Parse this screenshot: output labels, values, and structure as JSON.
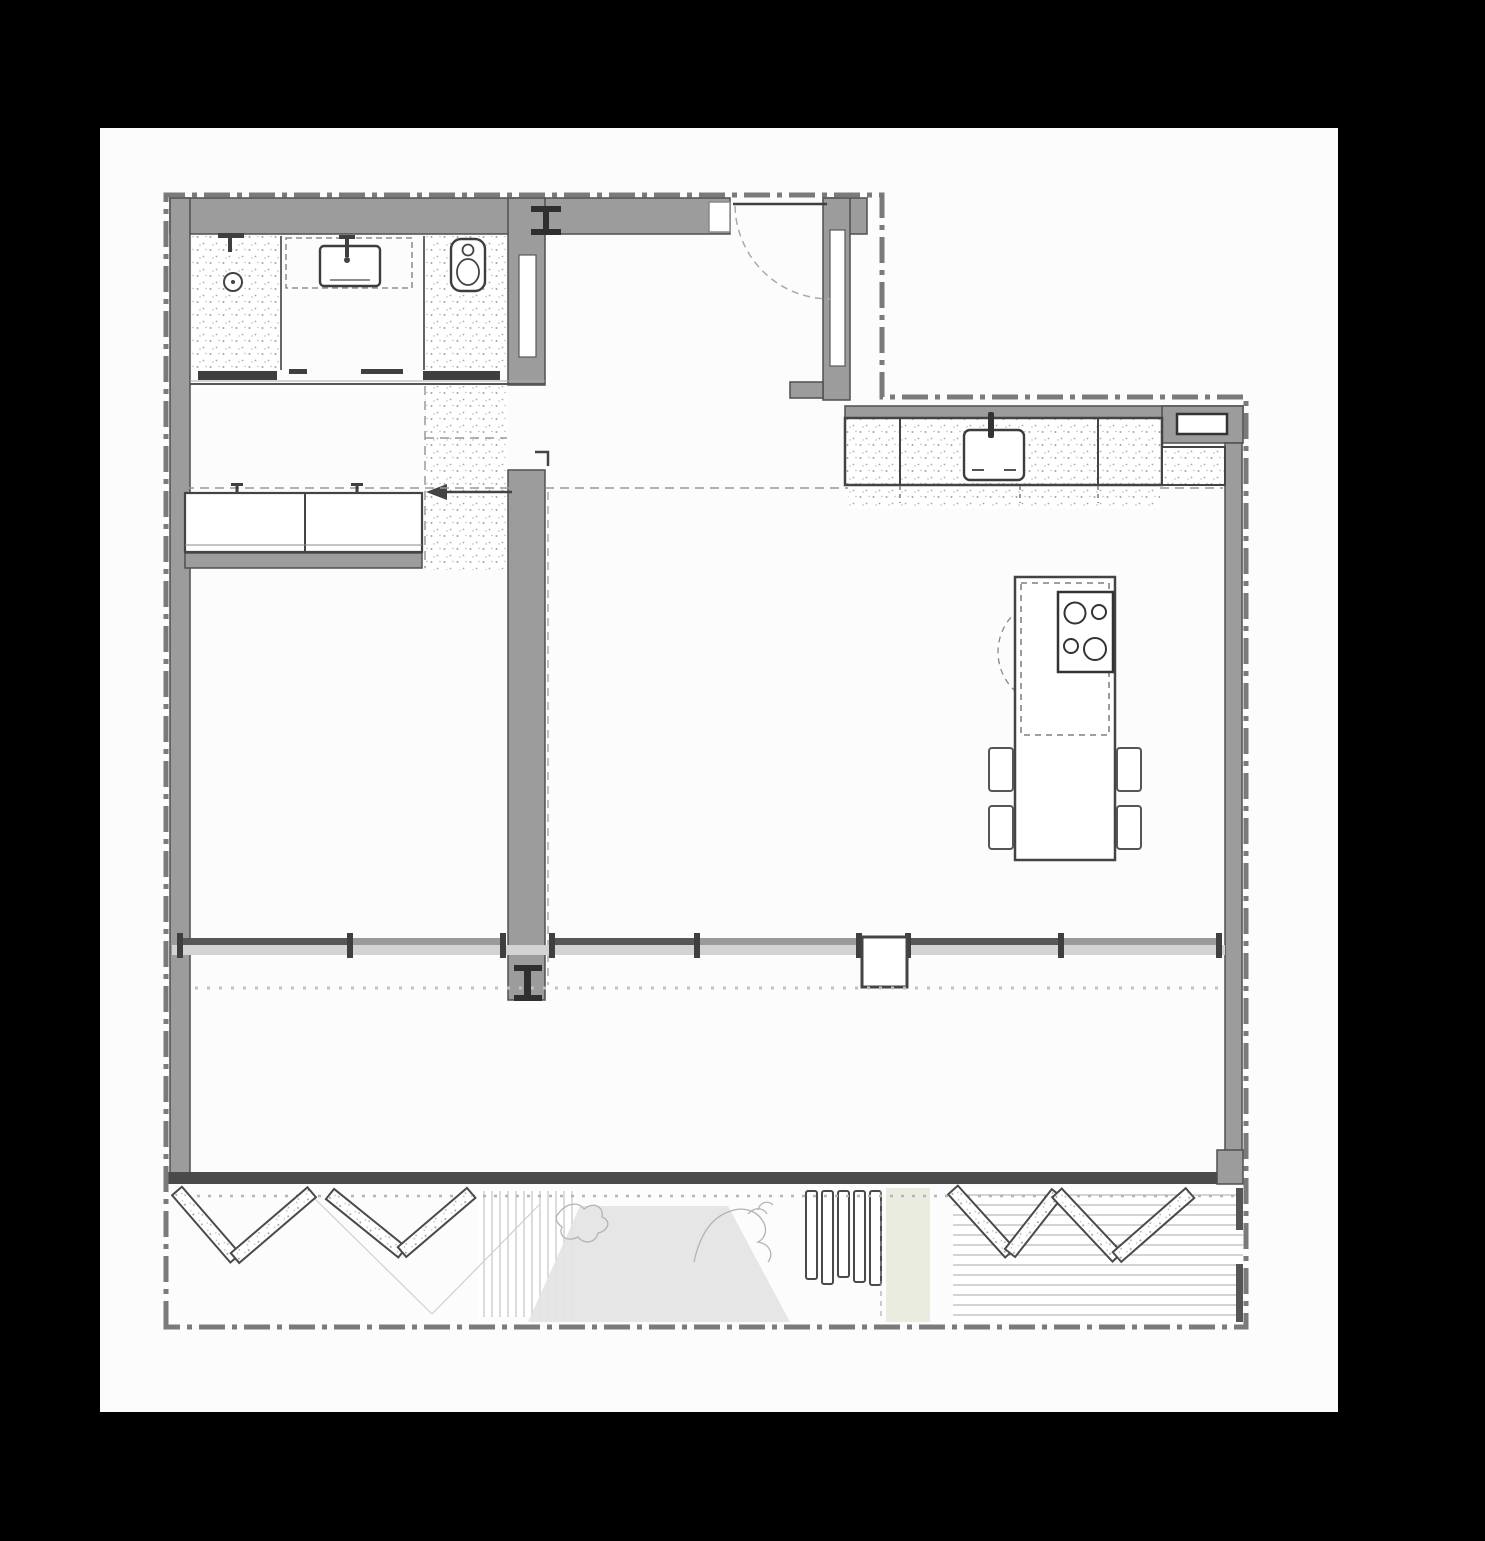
{
  "canvas": {
    "width": 1485,
    "height": 1541,
    "background": "#000000",
    "page_fill": "#fcfcfc"
  },
  "plan": {
    "type": "architectural-floor-plan",
    "view": "top-down apartment plan, no text labels",
    "colors": {
      "wall": "#9c9c9c",
      "wall_edge": "#4f4f4f",
      "dark_line": "#3f3f3f",
      "glass_band": "#d3d3d3",
      "boundary": "#7a7a7a",
      "speckle": "#a8a8a8",
      "shadow": "#e3e3e3",
      "green_tint": "#e9ecdf",
      "deck_stripe": "#c2c2c2"
    },
    "boundary": {
      "style": "dash-dot",
      "shape": "stepped-rectangle around unit and lot"
    },
    "rooms": [
      {
        "id": "bathroom",
        "zones": [
          "shower",
          "vanity",
          "wc"
        ],
        "fixtures": [
          "shower-head",
          "shower-drain",
          "washbasin-with-faucet",
          "toilet",
          "sliding-door-left",
          "sliding-door-right"
        ]
      },
      {
        "id": "dressing-hall",
        "fixtures": [
          "wardrobe-2-sections",
          "pocket-sliding-door-with-arrow",
          "dashed-ceiling-line"
        ]
      },
      {
        "id": "bedroom",
        "fixtures": []
      },
      {
        "id": "entry",
        "fixtures": [
          "entrance-door-with-swing-arc",
          "wall-niche"
        ]
      },
      {
        "id": "kitchen",
        "fixtures": [
          "counter-run",
          "kitchen-sink-with-faucet",
          "built-in-appliance",
          "island",
          "cooktop-4-burners",
          "stools-4",
          "hood-dashed-circle"
        ]
      },
      {
        "id": "living-dining",
        "fixtures": [
          "glazed-window-wall",
          "column-marker-top",
          "column-marker-pier",
          "hollow-column"
        ]
      },
      {
        "id": "enclosed-terrace",
        "fixtures": [
          "dotted-canopy-line"
        ]
      },
      {
        "id": "outdoor-strip",
        "fixtures": [
          "bifold-doors-left-4",
          "bifold-doors-right-4",
          "slatted-screen",
          "planting-sketch",
          "deck-boards",
          "cast-shadow"
        ]
      }
    ],
    "counts": {
      "bifold_panels": 8,
      "cooktop_burners": 4,
      "island_stools": 4,
      "wardrobe_sections": 2,
      "sliding_doors": 3,
      "column_markers": 2
    }
  }
}
